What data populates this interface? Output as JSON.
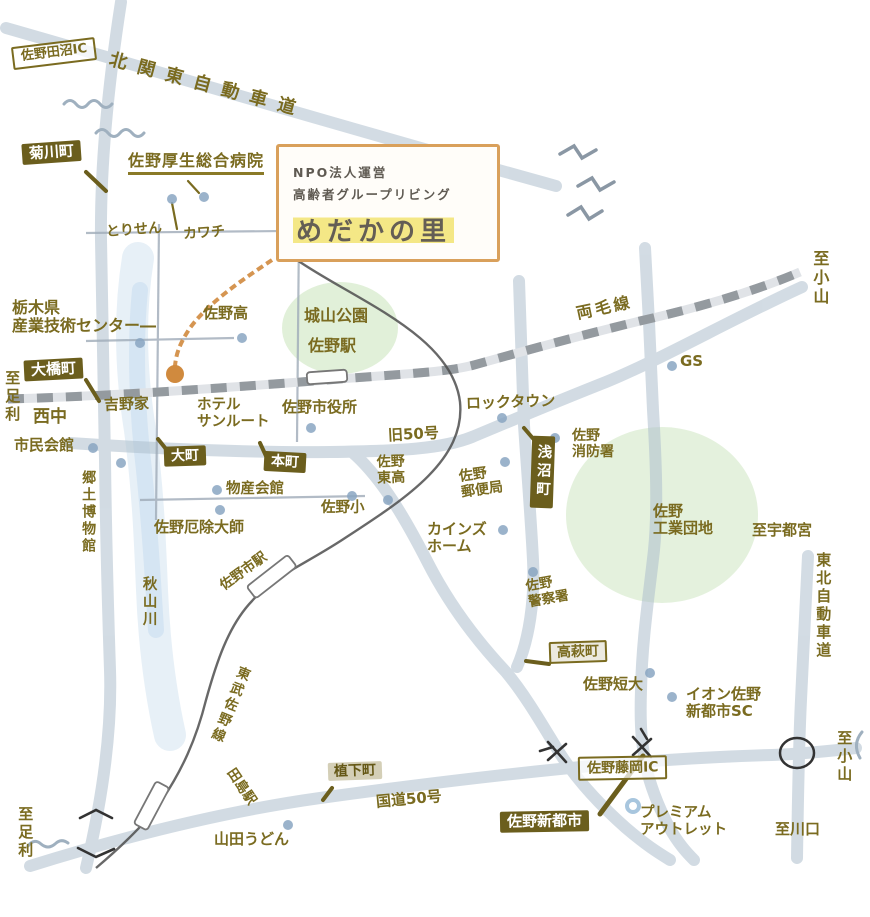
{
  "title_box": {
    "line1": "NPO法人運営",
    "line2": "高齢者グループリビング",
    "name": "めだかの里"
  },
  "labels": {
    "tanuma_ic": "佐野田沼IC",
    "kita_kanto": "北関東自動車道",
    "kikugawa": "菊川町",
    "hospital": "佐野厚生総合病院",
    "torisen": "とりせん",
    "kawachi": "カワチ",
    "tochigi1": "栃木県",
    "tochigi2": "産業技術センター―",
    "sano_high": "佐野高",
    "shiroyama_park": "城山公園",
    "sano_station": "佐野駅",
    "ryomo_line": "両毛線",
    "to_oyama_ne": "至小山",
    "gs": "GS",
    "ohashi": "大橋町",
    "to_ashikaga_w": "至足利",
    "nishichu": "西中",
    "yoshinoya": "吉野家",
    "hotel1": "ホテル",
    "hotel2": "サンルート",
    "shiyakusho": "佐野市役所",
    "rocktown": "ロックタウン",
    "kyu50": "旧50号",
    "shimin_kaikan": "市民会館",
    "omachi": "大町",
    "honcho": "本町",
    "asanuma": "浅沼町",
    "shobo1": "佐野",
    "shobo2": "消防署",
    "bussan": "物産会館",
    "kyodo_museum": "郷土博物館",
    "yakuyoke": "佐野厄除大師",
    "higashi1": "佐野",
    "higashi2": "東高",
    "sano_sho": "佐野小",
    "yubin1": "佐野",
    "yubin2": "郵便局",
    "cainz1": "カインズ",
    "cainz2": "ホーム",
    "kogyo1": "佐野",
    "kogyo2": "工業団地",
    "to_utsunomiya": "至宇都宮",
    "akiyama": "秋山川",
    "sanoshi_station": "佐野市駅",
    "keisatsu1": "佐野",
    "keisatsu2": "警察署",
    "takahagi": "高萩町",
    "tobu_line": "東武佐野線",
    "tandai": "佐野短大",
    "aeon1": "イオン佐野",
    "aeon2": "新都市SC",
    "tohoku_expwy": "東北自動車道",
    "tajima_station": "田島駅",
    "uetsuka": "植下町",
    "kokudo50": "国道50号",
    "yamada_udon": "山田うどん",
    "shintoshi": "佐野新都市",
    "fujioka_ic": "佐野藤岡IC",
    "premium1": "プレミアム",
    "premium2": "アウトレット",
    "to_kawaguchi": "至川口",
    "to_oyama_se": "至小山",
    "to_ashikaga_s": "至足利"
  },
  "colors": {
    "label_olive": "#7a6b20",
    "badge_bg": "#6b5e1d",
    "badge_text": "#ffffff",
    "title_border_orange": "#d9a05b",
    "route_orange": "#d08a3e",
    "road_gray_blue": "#aebfcd",
    "railway_dash_gray": "#8c9197",
    "tobu_line_dark": "#4e4e4e",
    "park_green": "#dcedd2",
    "river_blue": "#c3d9ec",
    "highlight_yellow": "#f3e57a",
    "poi_dot_blue": "#8aa6c2"
  }
}
